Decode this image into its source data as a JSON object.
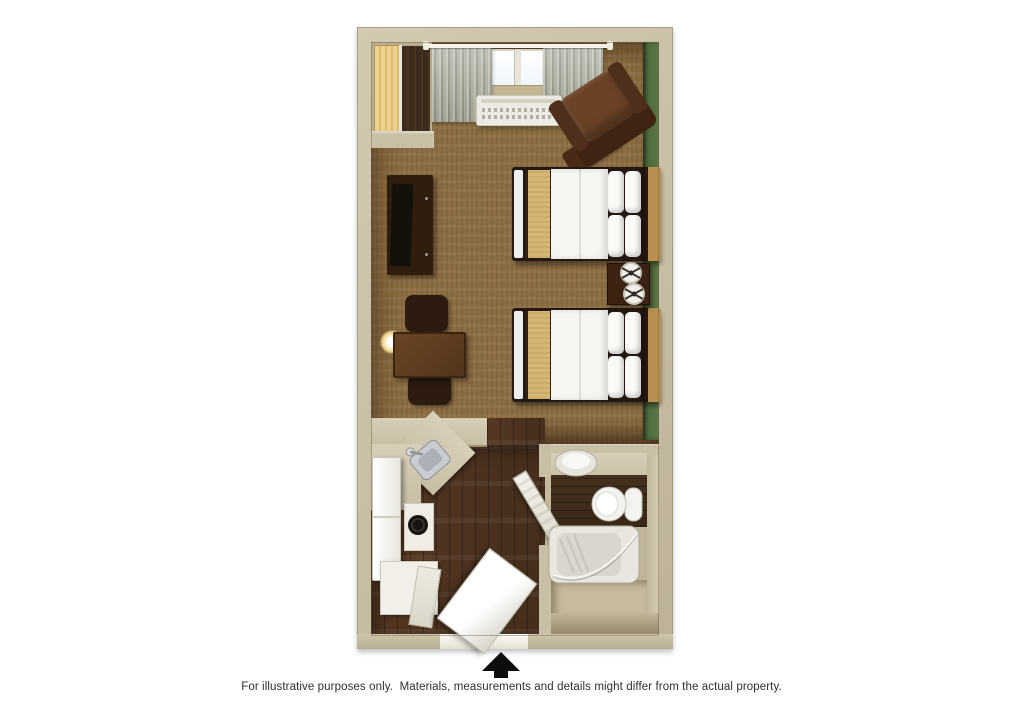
{
  "caption": "For illustrative purposes only.  Materials, measurements and details might differ from the actual property.",
  "floor_plan": {
    "type": "hotel-studio-room-top-view-3d-render",
    "entrance_marker": "black up arrow at bottom center",
    "colors": {
      "page_background": "#ffffff",
      "wall_tan": "#c9bfa6",
      "accent_wall_green": "#4e6a3c",
      "carpet_brown": "#8d6e42",
      "wood_floor_walnut": "#4a3220",
      "bedding_white": "#f6f5f1",
      "bed_runner_tan": "#d6b673",
      "headboard_wood": "#b78f4e",
      "dark_furniture": "#2f1d0e",
      "armchair_leather": "#6b4226",
      "curtain_gray": "#a4a496",
      "appliance_white": "#f1efe8",
      "counter_beige": "#d2c9b2",
      "fixture_white": "#f4f3ef",
      "arrow_black": "#0d0d0d"
    },
    "areas": {
      "main_room": {
        "items": [
          "closet-wardrobe",
          "window",
          "curtains",
          "curtain-rod",
          "ac-unit",
          "armchair",
          "ottoman",
          "dresser-with-tv",
          "wall-lamp",
          "dining-table",
          "two-chairs",
          "bed-1",
          "bed-2",
          "nightstand",
          "two-table-lamps",
          "green-accent-wall"
        ]
      },
      "kitchenette": {
        "items": [
          "counter-with-corner-sink",
          "faucet",
          "refrigerator",
          "cooktop-burner",
          "lower-cabinet",
          "entry-door-open"
        ]
      },
      "bathroom": {
        "items": [
          "vanity-oval-sink",
          "toilet",
          "bathtub",
          "shower-curtain",
          "bathroom-door-open"
        ]
      }
    }
  }
}
